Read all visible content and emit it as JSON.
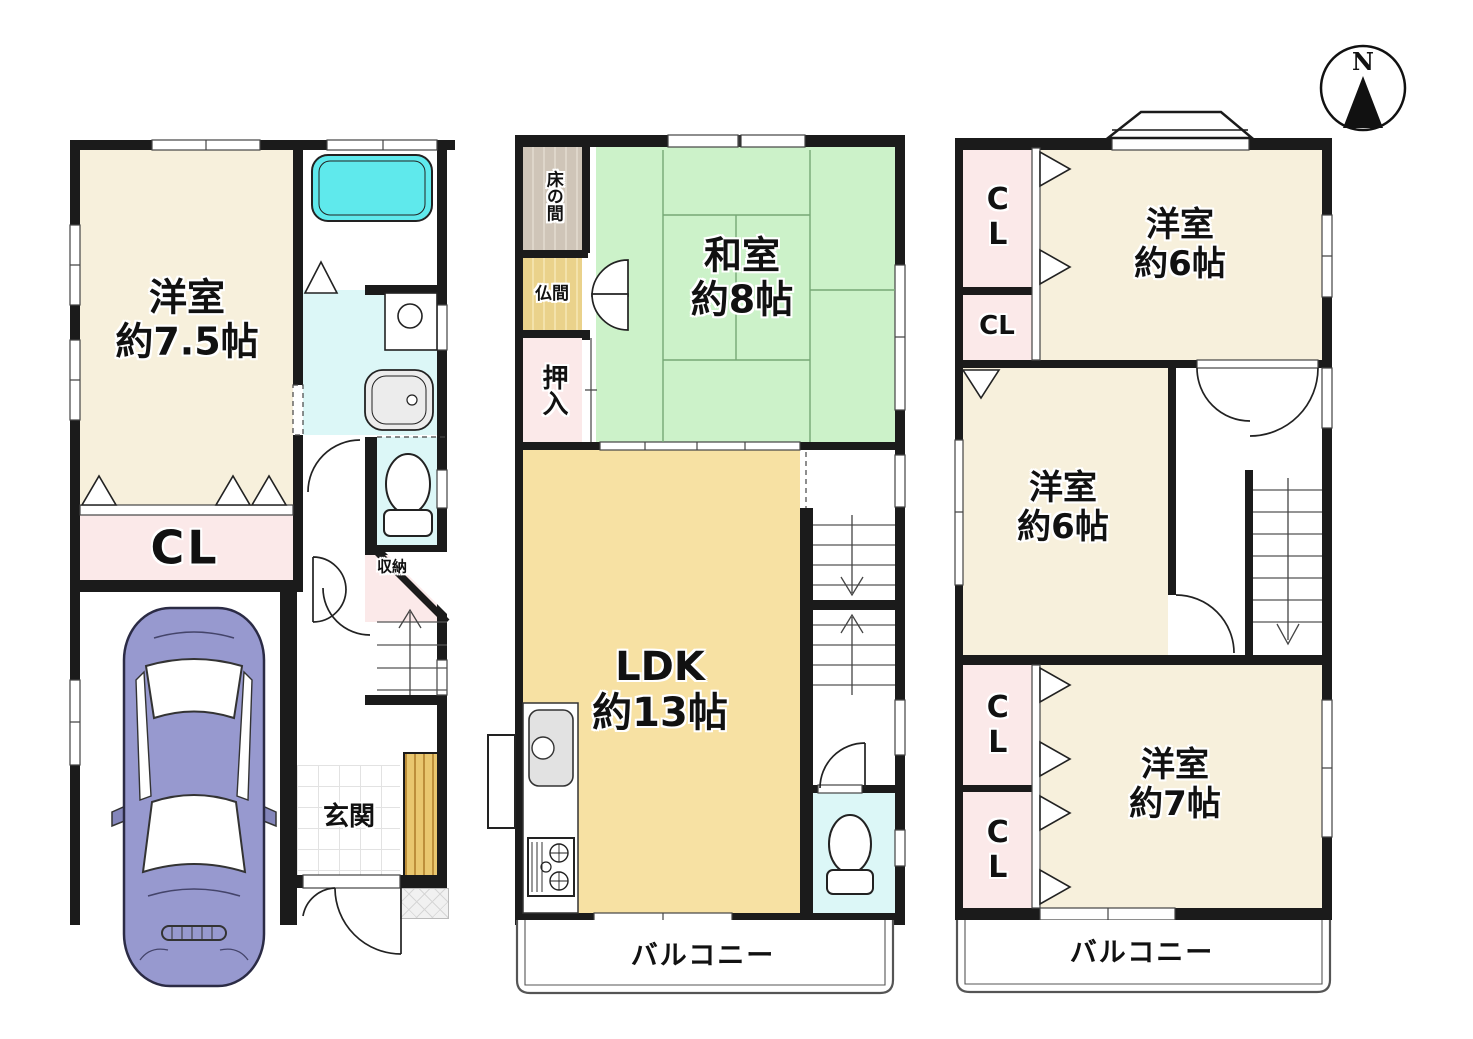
{
  "compass": {
    "north_label": "N"
  },
  "floor1": {
    "western_room": {
      "name": "洋室",
      "size": "約7.5帖"
    },
    "closet_label": "CL",
    "storage_label": "収納",
    "entrance_label": "玄関"
  },
  "floor2": {
    "alcove_label": "床の間",
    "buddhist_room_label": "仏間",
    "futon_closet_label": "押入",
    "japanese_room": {
      "name": "和室",
      "size": "約8帖"
    },
    "ldk": {
      "name": "LDK",
      "size": "約13帖"
    },
    "balcony_label": "バルコニー"
  },
  "floor3": {
    "closet1_label": "CL",
    "closet2_label": "CL",
    "closet3_label": "CL",
    "closet4_label": "CL",
    "western_room_top": {
      "name": "洋室",
      "size": "約6帖"
    },
    "western_room_middle": {
      "name": "洋室",
      "size": "約6帖"
    },
    "western_room_bottom": {
      "name": "洋室",
      "size": "約7帖"
    },
    "balcony_label": "バルコニー"
  },
  "colors": {
    "wall": "#1b1b1b",
    "cream_room": "#F7F0DC",
    "pink_closet": "#FBE9E9",
    "tatami_green": "#CCF2C9",
    "ldk_wheat": "#F7E1A3",
    "sanitary_cyan": "#DCF7F7",
    "bathtub_cyan": "#5FE9EC",
    "alcove_brown": "#CFC5B8",
    "buddhist_tan": "#EAD28B",
    "car_purple": "#9799CF",
    "deck_wood": "#E9C76F"
  }
}
